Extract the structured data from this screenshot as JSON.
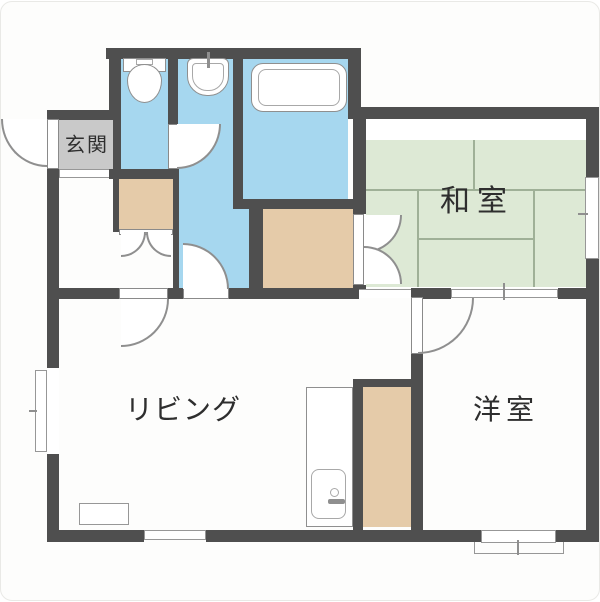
{
  "title": "apartment-floor-plan",
  "rooms": {
    "entry": {
      "label": "玄関"
    },
    "japanese_room": {
      "label": "和室"
    },
    "living": {
      "label": "リビング"
    },
    "western_room": {
      "label": "洋室"
    }
  },
  "fixtures": [
    "toilet-icon",
    "washbasin-icon",
    "bathtub-icon",
    "kitchen-sink-icon"
  ],
  "colors": {
    "wall": "#4f4f4f",
    "water_area": "#a6d7ef",
    "tatami": "#dde9d5",
    "closet": "#e5cba9",
    "entry_floor": "#c9c9c9",
    "background": "#fdfdfc"
  }
}
